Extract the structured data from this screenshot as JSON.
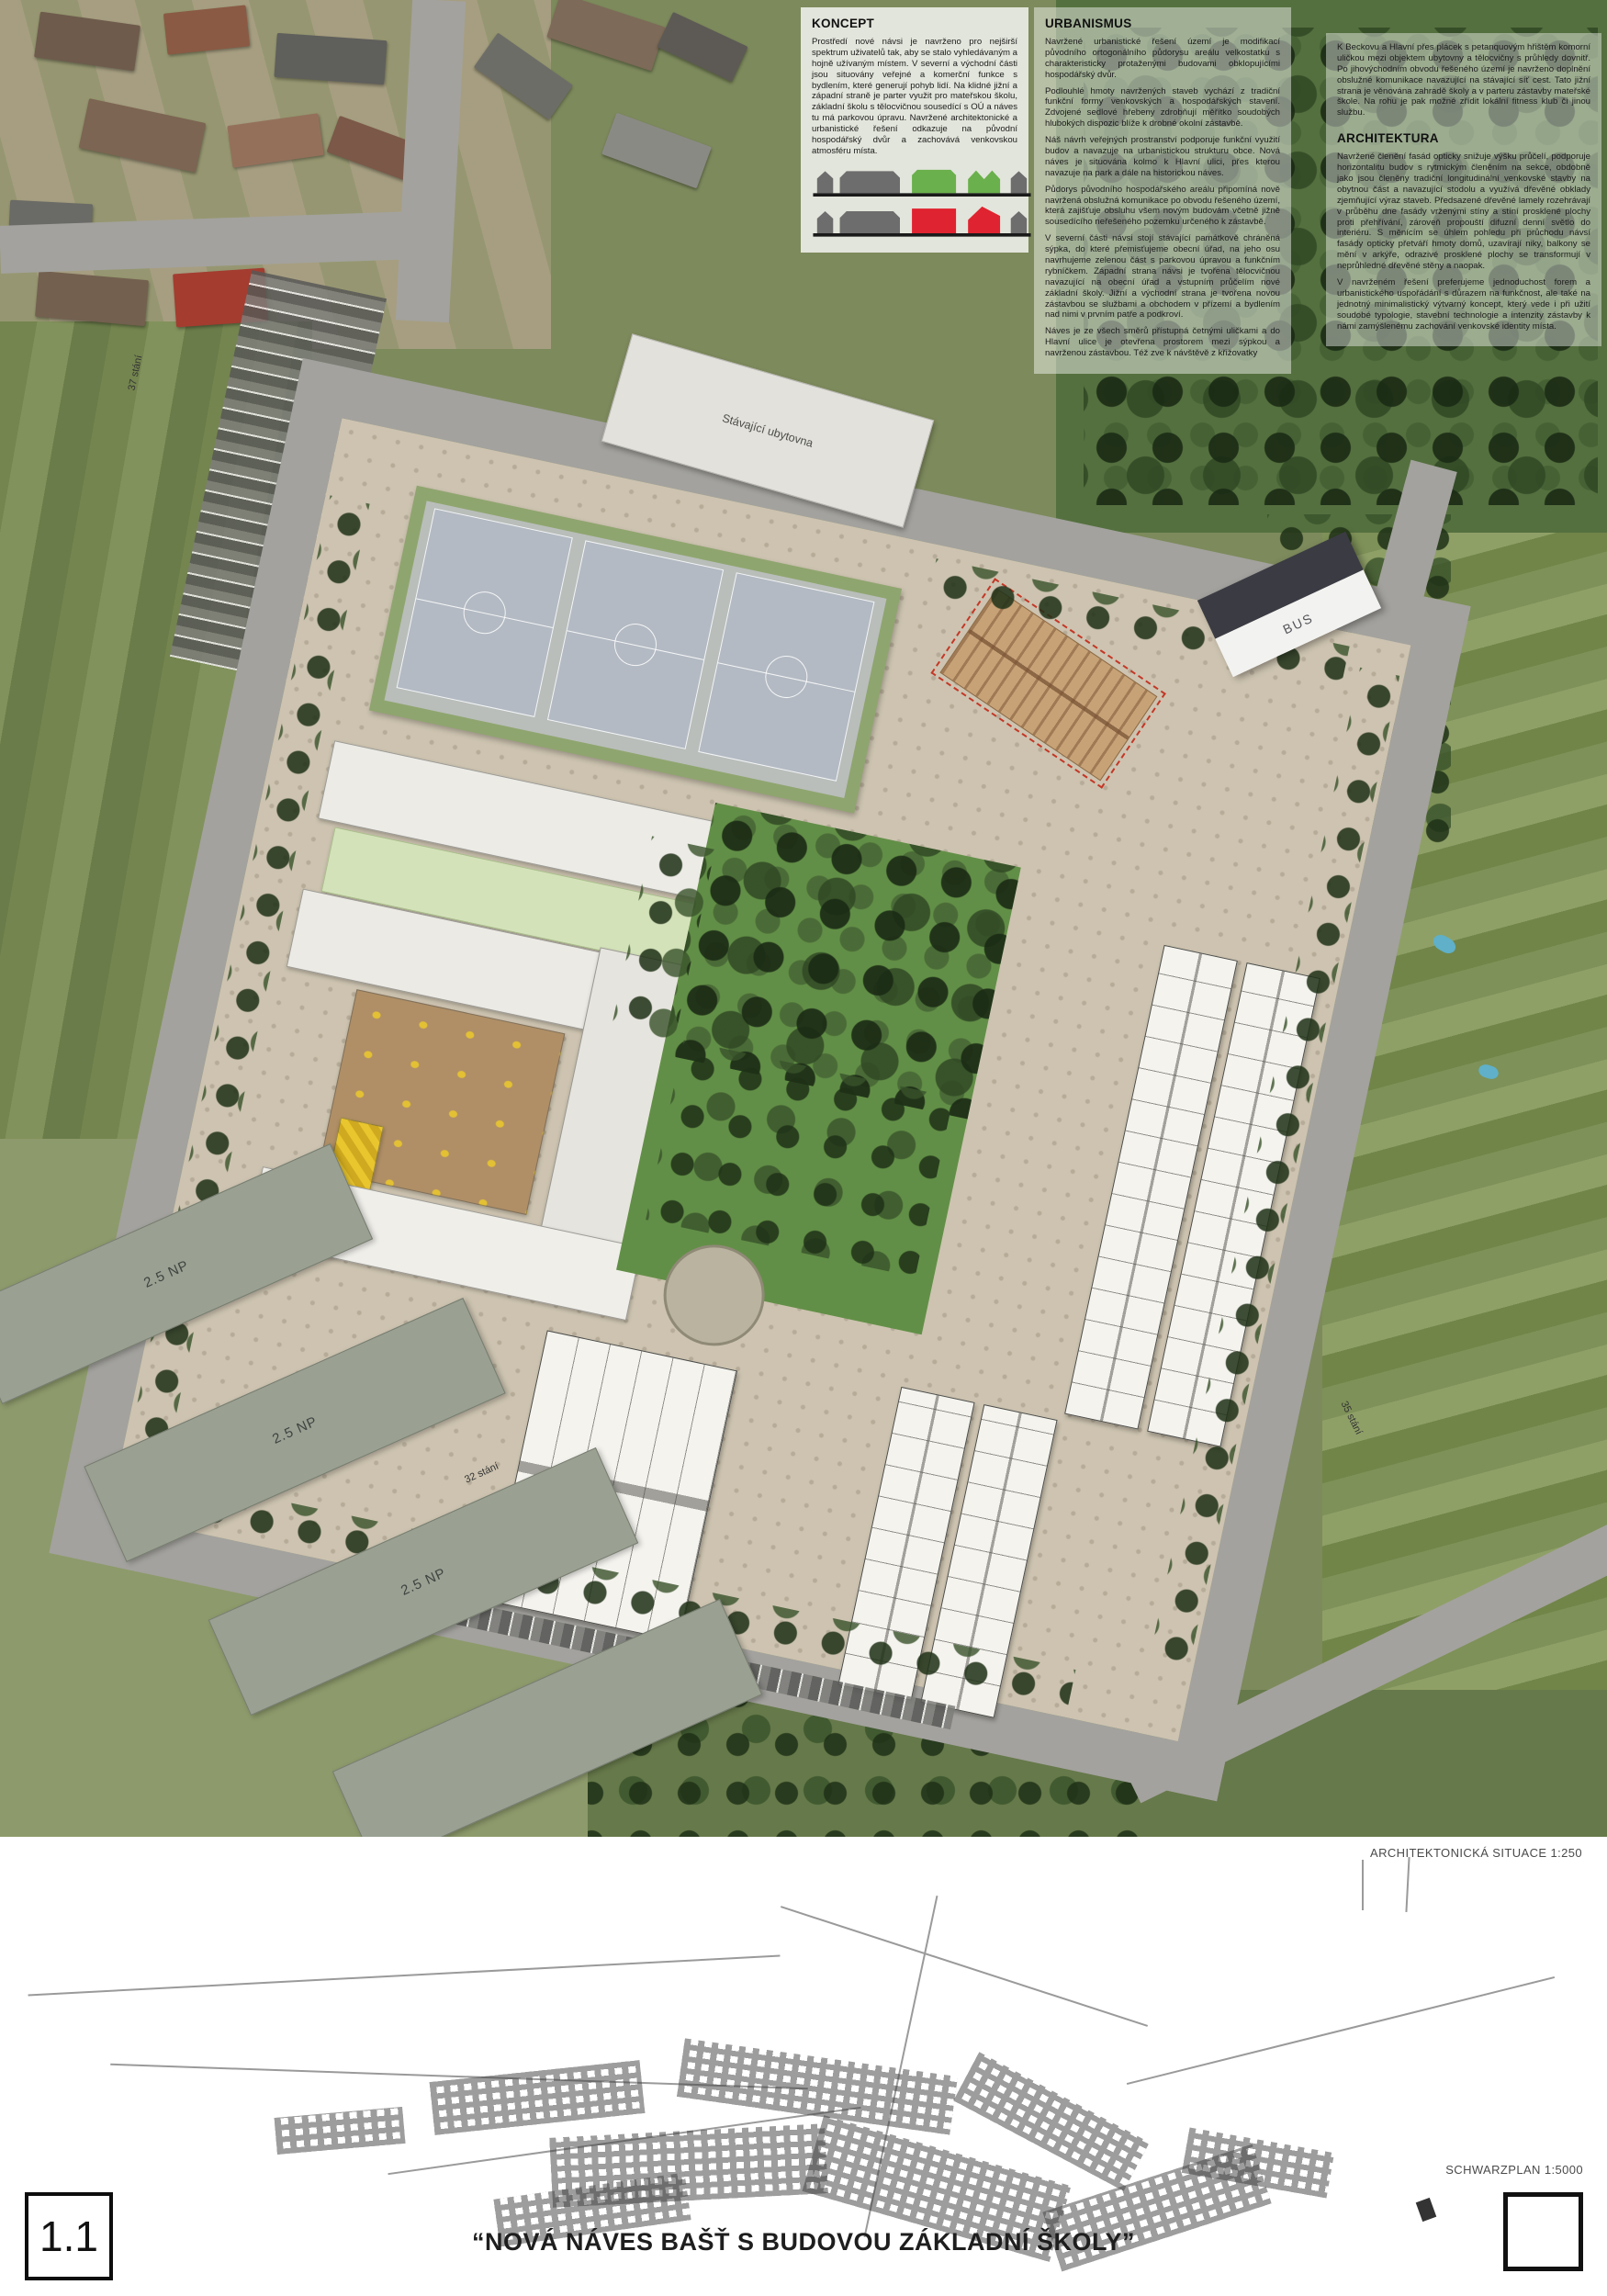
{
  "sections": {
    "koncept": {
      "heading": "KONCEPT",
      "paragraph": "Prostředí nové návsi je navrženo pro nejširší spektrum uživatelů tak, aby se stalo vyhledávaným a hojně užívaným místem. V severní a východní části jsou situovány veřejné a komerční funkce s bydlením, které generují pohyb lidí. Na klidné jižní a západní straně je parter využit pro mateřskou školu, základní školu s tělocvičnou sousedící s OÚ a náves tu má parkovou úpravu. Navržené architektonické a urbanistické řešení odkazuje na původní hospodářský dvůr a zachovává venkovskou atmosféru místa."
    },
    "urbanismus": {
      "heading": "URBANISMUS",
      "paragraphs": [
        "Navržené urbanistické řešení území je modifikací původního ortogonálního půdorysu areálu velkostatku s charakteristicky protaženými budovami obklopujícími hospodářský dvůr.",
        "Podlouhlé hmoty navržených staveb vychází z tradiční funkční formy venkovských a hospodářských stavení. Zdvojené sedlové hřebeny zdrobňují měřítko soudobých hlubokých dispozic blíže k drobné okolní zástavbě.",
        "Náš návrh veřejných prostranství podporuje funkční využití budov a navazuje na urbanistickou strukturu obce. Nová náves je situována kolmo k Hlavní ulici, přes kterou navazuje na park a dále na historickou náves.",
        "Půdorys původního hospodářského areálu připomíná nově navržená obslužná komunikace po obvodu řešeného území, která zajišťuje obsluhu všem novým budovám včetně jižně sousedícího neřešeného pozemku určeného k zástavbě.",
        "V severní části návsi stojí stávající památkově chráněná sýpka, do které přemisťujeme obecní úřad, na jeho osu navrhujeme zelenou část s parkovou úpravou a funkčním rybníčkem. Západní strana návsi je tvořena tělocvičnou navazující na obecní úřad a vstupním průčelím nové základní školy. Jižní a východní strana je tvořena novou zástavbou se službami a obchodem v přízemí a bydlením nad nimi v prvním patře a podkroví.",
        "Náves je ze všech směrů přístupná četnými uličkami a do Hlavní ulice je otevřena prostorem mezi sýpkou a navrženou zástavbou. Též zve k návštěvě z křižovatky"
      ]
    },
    "architektura": {
      "intro": "K Beckovu a Hlavní přes plácek s petanquovým hřištěm komorní uličkou mezi objektem ubytovny a tělocvičny s průhledy dovnitř. Po jihovýchodním obvodu řešeného území je navrženo doplnění obslužné komunikace navazující na stávající síť cest. Tato jižní strana je věnována zahradě školy a v parteru zástavby mateřské škole. Na rohu je pak možné zřídit lokální fitness klub či jinou službu.",
      "heading": "ARCHITEKTURA",
      "paragraphs": [
        "Navržené členění fasád opticky snižuje výšku průčelí, podporuje horizontalitu budov s rytmickým členěním na sekce, obdobně jako jsou členěny tradiční longitudinální venkovské stavby na obytnou část a navazující stodolu a využívá dřevěné obklady zjemňující výraz staveb. Předsazené dřevěné lamely rozehrávají v průběhu dne fasády vrženými stíny a stíní prosklené plochy proti přehřívání, zároveň propouští difuzní denní světlo do interiéru. S měnícím se úhlem pohledu při průchodu návsí fasády opticky přetváří hmoty domů, uzavírají niky, balkony se mění v arkýře, odrazivé prosklené plochy se transformují v neprůhledné dřevěné stěny a naopak.",
        "V navrženém řešení preferujeme jednoduchost forem a urbanistického uspořádání s důrazem na funkčnost, ale také na jednotný minimalistický výtvarný koncept, který vede i při užití soudobé typologie, stavební technologie a intenzity zástavby k námi zamýšlenému zachování venkovské identity místa."
      ]
    }
  },
  "plan": {
    "labels": {
      "bus": "BUS",
      "existing_hostel": "Stávající ubytovna",
      "floors_1": "2.5 NP",
      "floors_2": "2.5 NP",
      "floors_3": "2.5 NP",
      "parking_west": "37 stání",
      "parking_south": "32 stání",
      "parking_east": "35 stání"
    }
  },
  "footer": {
    "situation_label": "ARCHITEKTONICKÁ SITUACE 1:250",
    "schwarzplan_label": "SCHWARZPLAN 1:5000",
    "sheet_number": "1.1",
    "title": "“NOVÁ NÁVES BAŠŤ S BUDOVOU ZÁKLADNÍ ŠKOLY”"
  },
  "colors": {
    "accent_red": "#e02330",
    "accent_green": "#6ab04c",
    "massing_gray": "#6d6d6d",
    "sypka_outline_red": "#c43726",
    "paving_beige": "#cdc3b0",
    "park_green": "#628f47",
    "road_gray": "#a3a29e"
  }
}
